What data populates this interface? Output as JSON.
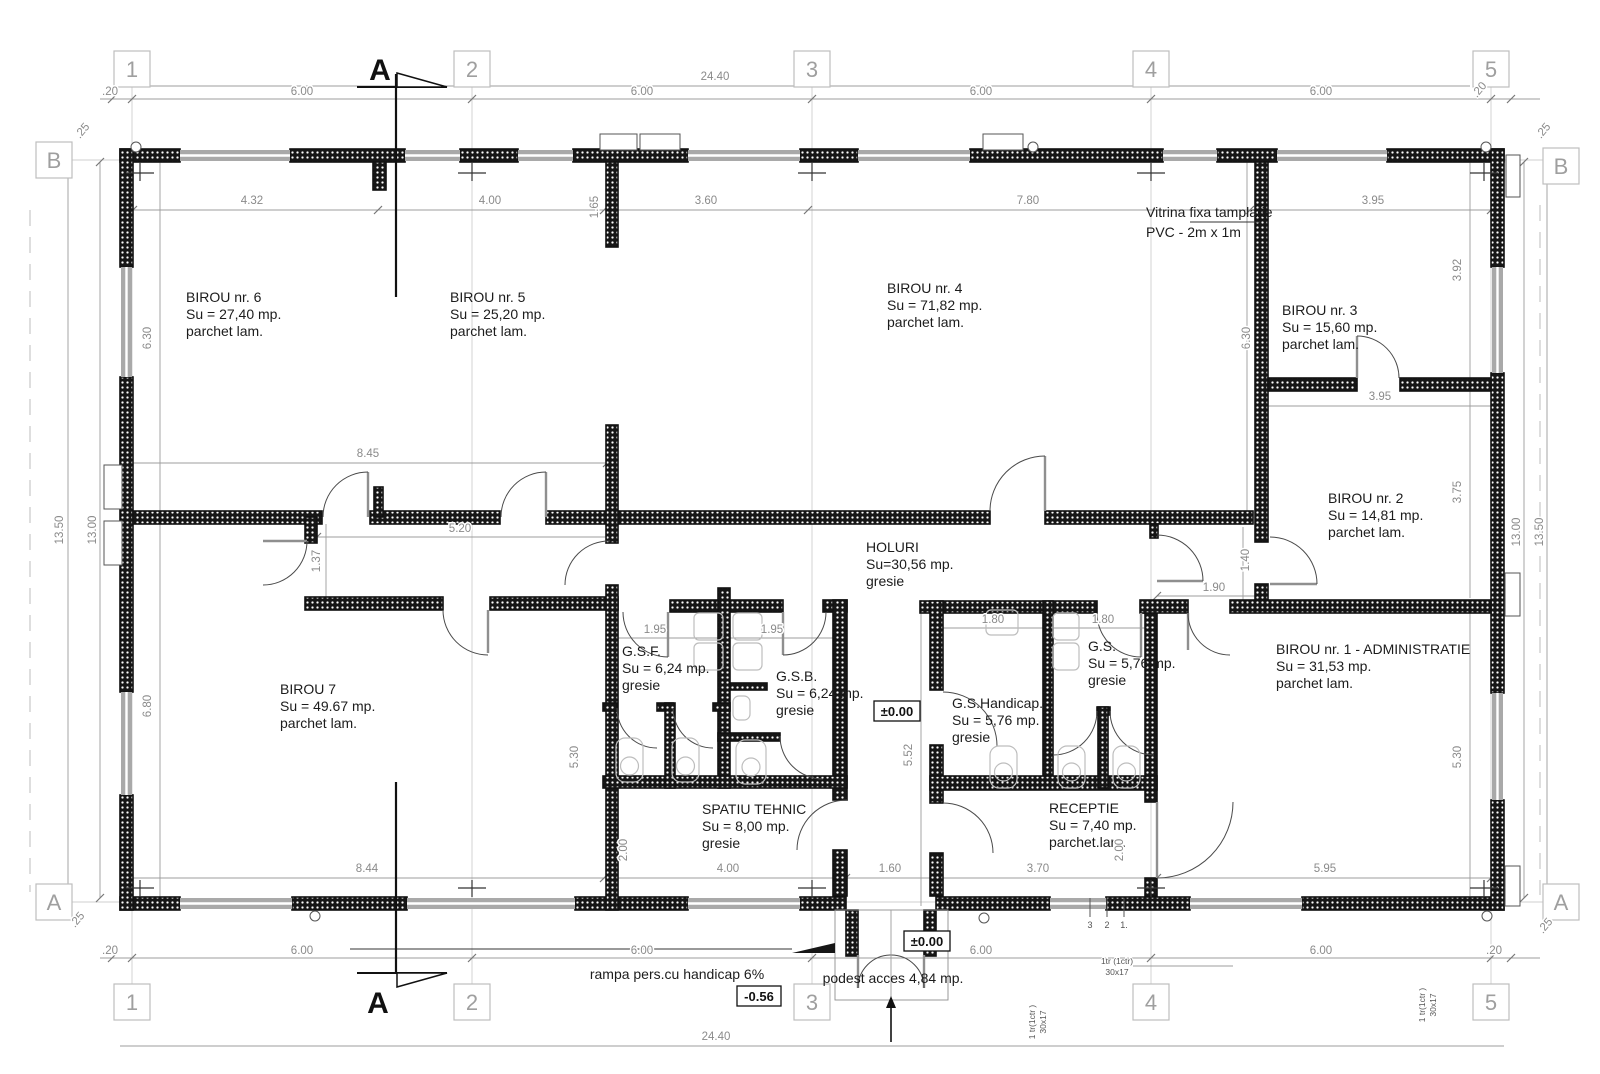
{
  "grid": {
    "cols": [
      "1",
      "2",
      "3",
      "4",
      "5"
    ],
    "rows_left": [
      "B",
      "A"
    ],
    "rows_right": [
      "B",
      "A"
    ],
    "section_label": "A"
  },
  "rooms": [
    {
      "name": "BIROU nr. 6",
      "area": "Su = 27,40 mp.",
      "floor": "parchet lam."
    },
    {
      "name": "BIROU nr. 5",
      "area": "Su = 25,20 mp.",
      "floor": "parchet lam."
    },
    {
      "name": "BIROU nr. 4",
      "area": "Su = 71,82 mp.",
      "floor": "parchet lam."
    },
    {
      "name": "BIROU nr. 3",
      "area": "Su = 15,60 mp.",
      "floor": "parchet lam."
    },
    {
      "name": "BIROU nr. 2",
      "area": "Su = 14,81 mp.",
      "floor": "parchet lam."
    },
    {
      "name": "BIROU nr. 1 - ADMINISTRATIE",
      "area": "Su = 31,53 mp.",
      "floor": "parchet lam."
    },
    {
      "name": "BIROU 7",
      "area": "Su = 49.67 mp.",
      "floor": "parchet lam."
    },
    {
      "name": "HOLURI",
      "area": "Su=30,56 mp.",
      "floor": "gresie"
    },
    {
      "name": "G.S.F.",
      "area": "Su = 6,24 mp.",
      "floor": "gresie"
    },
    {
      "name": "G.S.B.",
      "area": "Su = 6,24 mp.",
      "floor": "gresie"
    },
    {
      "name": "G.S.Handicap.",
      "area": "Su = 5,76 mp.",
      "floor": "gresie"
    },
    {
      "name": "G.S.",
      "area": "Su = 5,76 mp.",
      "floor": "gresie"
    },
    {
      "name": "SPATIU TEHNIC",
      "area": "Su = 8,00 mp.",
      "floor": "gresie"
    },
    {
      "name": "RECEPTIE",
      "area": "Su = 7,40 mp.",
      "floor": "parchet.lam."
    }
  ],
  "dims": [
    "24.40",
    ".20",
    "6.00",
    "6.00",
    "6.00",
    "6.00",
    ".20",
    ".25",
    ".25",
    "4.32",
    "4.00",
    "3.60",
    "7.80",
    "3.95",
    "1.65",
    "3.92",
    "6.30",
    "6.30",
    "3.95",
    "3.75",
    "8.45",
    "5.20",
    "1.37",
    "13.50",
    "13.00",
    "13.00",
    "13.50",
    "1.40",
    "1.90",
    "1.95",
    "1.95",
    "1.80",
    "1.80",
    "5.30",
    "5.52",
    "5.30",
    "6.80",
    "2.00",
    "2.00",
    "8.44",
    "4.00",
    "1.60",
    "3.70",
    "5.95",
    ".25",
    ".25",
    ".20",
    "6.00",
    "6.00",
    "6.00",
    "6.00",
    ".20",
    "24.40"
  ],
  "annotations": {
    "vitrina_line1": "Vitrina fixa tamplarie",
    "vitrina_line2": "PVC - 2m x 1m",
    "ramp": "rampa pers.cu handicap 6%",
    "podest": "podest acces 4,84 mp.",
    "level_entry": "±0.00",
    "level_hall": "±0.00",
    "level_ramp": "-0.56",
    "stair_note_line1": "1tr (1ctr)",
    "stair_note_line2": "30x17",
    "stair_note_side_line1": "1 tr(1ctr )",
    "stair_note_side_line2": "30x17",
    "steps": [
      "3",
      "2",
      "1."
    ]
  },
  "colors": {
    "wall": "#161616",
    "window": "#a9a9a9",
    "dim": "#8a8a8a",
    "grid": "#cfcfcf",
    "fixture": "#bdbdbd"
  }
}
